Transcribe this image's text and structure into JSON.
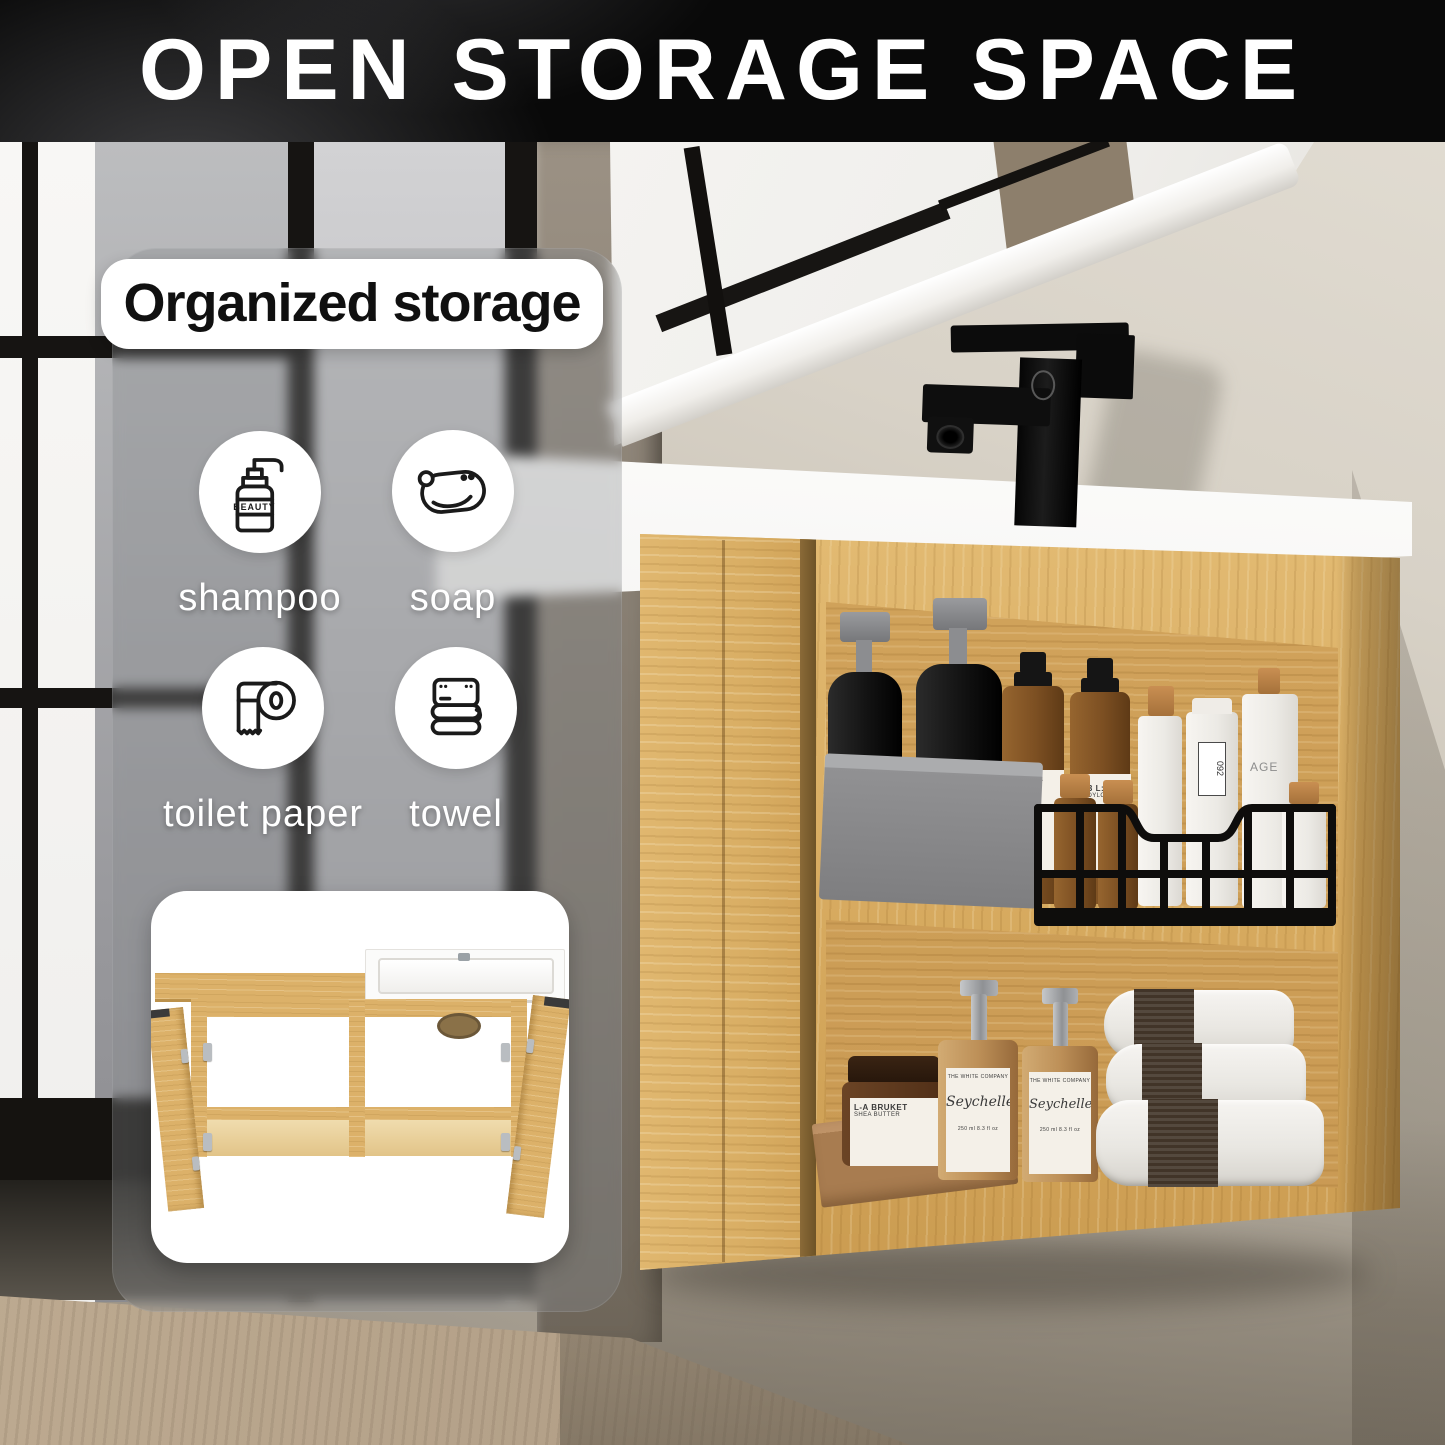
{
  "banner": {
    "title": "OPEN STORAGE SPACE"
  },
  "panel": {
    "heading": "Organized storage",
    "items": [
      {
        "label": "shampoo",
        "icon": "shampoo-pump-bottle-icon"
      },
      {
        "label": "soap",
        "icon": "soap-bar-icon"
      },
      {
        "label": "toilet paper",
        "icon": "toilet-paper-roll-icon"
      },
      {
        "label": "towel",
        "icon": "folded-towel-icon"
      }
    ],
    "icon_bottle_text": "BEAUTY"
  },
  "product_labels": {
    "lotion_line1": "123 L:A",
    "lotion_line2": "BODYLOT",
    "lotion_num": "092",
    "tube_num": "092",
    "pump_word": "AGE",
    "jar_line1": "L-A BRUKET",
    "jar_line2": "SHEA BUTTER",
    "hand_script": "Seychelles",
    "hand_size": "250 ml  8.3 fl oz"
  },
  "colors": {
    "banner_bg": "#090909",
    "wood": "#d9ae64",
    "wall": "#cfc9bd",
    "accent_white": "#ffffff",
    "faucet_black": "#0e0e0e"
  }
}
